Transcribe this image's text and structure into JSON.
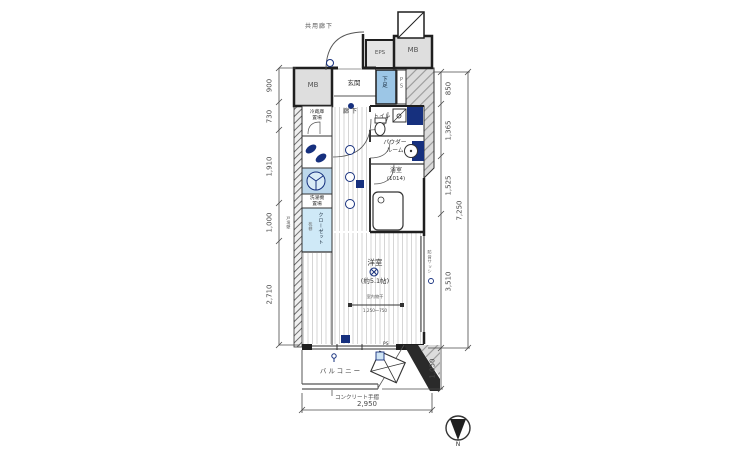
{
  "plan": {
    "top": {
      "common_corridor": "共用廊下",
      "mb_left": "MB",
      "eps": "EPS",
      "mb_right": "MB",
      "entrance": "玄関",
      "shoe_cabinet": "下足",
      "ps": "PS"
    },
    "middle": {
      "corridor": "廊下",
      "toilet": "トイレ",
      "powder_line1": "パウダー",
      "powder_line2": "ルーム",
      "bath": "浴室",
      "bath_size": "(1014)",
      "fridge_line1": "冷蔵庫",
      "fridge_line2": "置場",
      "washer_line1": "洗濯機",
      "washer_line2": "置場",
      "closet": "クローゼット",
      "closet_shelf": "枕棚",
      "party_wall": "戸境壁"
    },
    "room": {
      "name": "洋室",
      "size": "(約5.1帖)",
      "hanger": "室内物干",
      "hanger_range": "1,250～750",
      "window_note": "防音サッシ",
      "ps_small": "PS"
    },
    "bottom": {
      "balcony": "バルコニー",
      "handrail": "コンクリート手摺"
    },
    "compass": "N"
  },
  "dimensions": {
    "left": [
      "900",
      "730",
      "1,910",
      "1,000",
      "2,710"
    ],
    "right": [
      "850",
      "1,365",
      "1,525",
      "3,510"
    ],
    "right_total": "7,250",
    "balcony_depth": "1,050",
    "bottom_width": "2,950"
  },
  "colors": {
    "wall": "#1f1f1f",
    "fixture_navy": "#16307e",
    "fixture_blue": "#9cc6e6",
    "closet_blue": "#cfe9f7",
    "exterior_gray": "#dcdcdc",
    "dim_text": "#4a4a4a"
  }
}
